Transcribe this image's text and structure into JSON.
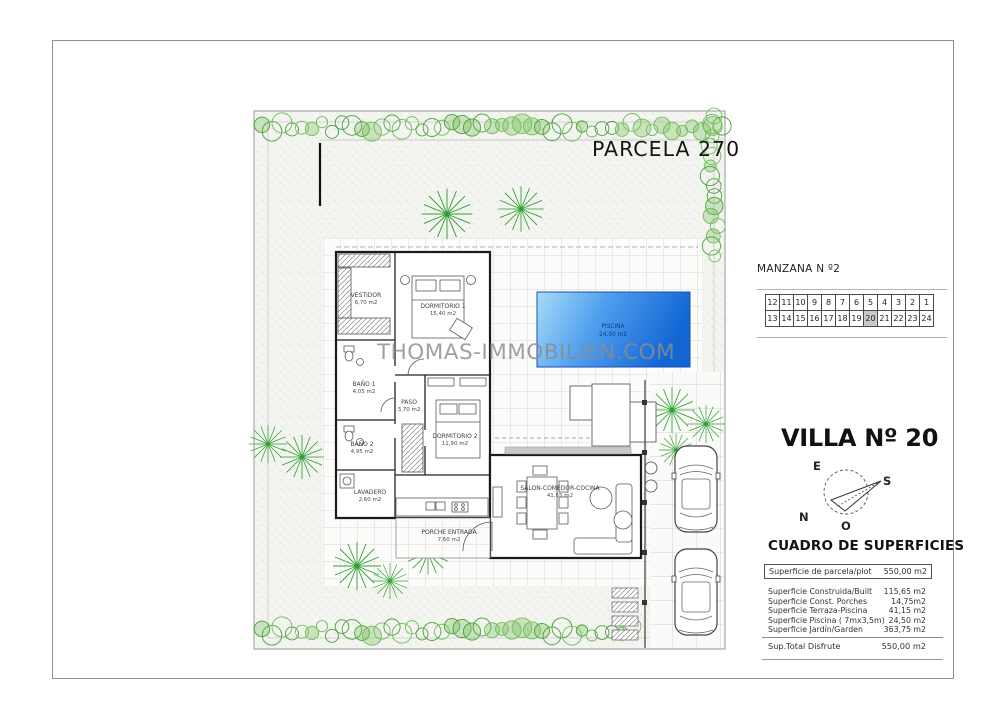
{
  "sheet": {
    "parcel_label": "PARCELA 270",
    "watermark": "THOMAS-IMMOBILIEN.COM"
  },
  "manzana": {
    "title": "MANZANA N º2",
    "row1": [
      "12",
      "11",
      "10",
      "9",
      "8",
      "7",
      "6",
      "5",
      "4",
      "3",
      "2",
      "1"
    ],
    "row2": [
      "13",
      "14",
      "15",
      "16",
      "17",
      "18",
      "19",
      "20",
      "21",
      "22",
      "23",
      "24"
    ],
    "highlighted": "20"
  },
  "villa": {
    "title": "VILLA Nº 20"
  },
  "compass": {
    "e": "E",
    "s": "S",
    "n": "N",
    "o": "O"
  },
  "surfaces": {
    "title": "CUADRO DE SUPERFICIES",
    "parcel": {
      "label": "Superficie de parcela/plot",
      "value": "550,00 m2"
    },
    "rows": [
      {
        "label": "Superficie Construida/Built",
        "value": "115,65 m2"
      },
      {
        "label": "Superficie Const. Porches",
        "value": "14,75m2"
      },
      {
        "label": "Superficie Terraza-Piscina",
        "value": "41,15 m2"
      },
      {
        "label": "Superficie Piscina ( 7mx3,5m)",
        "value": "24,50 m2"
      },
      {
        "label": "Superficie Jardín/Garden",
        "value": "363,75 m2"
      }
    ],
    "total": {
      "label": "Sup.Total Disfrute",
      "value": "550,00 m2"
    }
  },
  "plan": {
    "pool": {
      "label": "PISCINA",
      "area": "24,50 m2"
    },
    "rooms": [
      {
        "label": "VESTIDOR",
        "area": "6,70 m2"
      },
      {
        "label": "DORMITORIO 1",
        "area": "15,40 m2"
      },
      {
        "label": "BAÑO 1",
        "area": "4,05 m2"
      },
      {
        "label": "PASO",
        "area": "3,70 m2"
      },
      {
        "label": "DORMITORIO 2",
        "area": "11,90 m2"
      },
      {
        "label": "BAÑO 2",
        "area": "4,95 m2"
      },
      {
        "label": "LAVADERO",
        "area": "2,60 m2"
      },
      {
        "label": "SALON-COMEDOR-COCINA",
        "area": "41,55 m2"
      },
      {
        "label": "PORCHE ENTRADA",
        "area": "7,60 m2"
      }
    ]
  },
  "colors": {
    "pool_light": "#a8dcf8",
    "pool_dark": "#1266d4",
    "hedge_green": "#48a13c",
    "highlight_gray": "#c9c9c9",
    "wall_black": "#1b1b1b"
  }
}
